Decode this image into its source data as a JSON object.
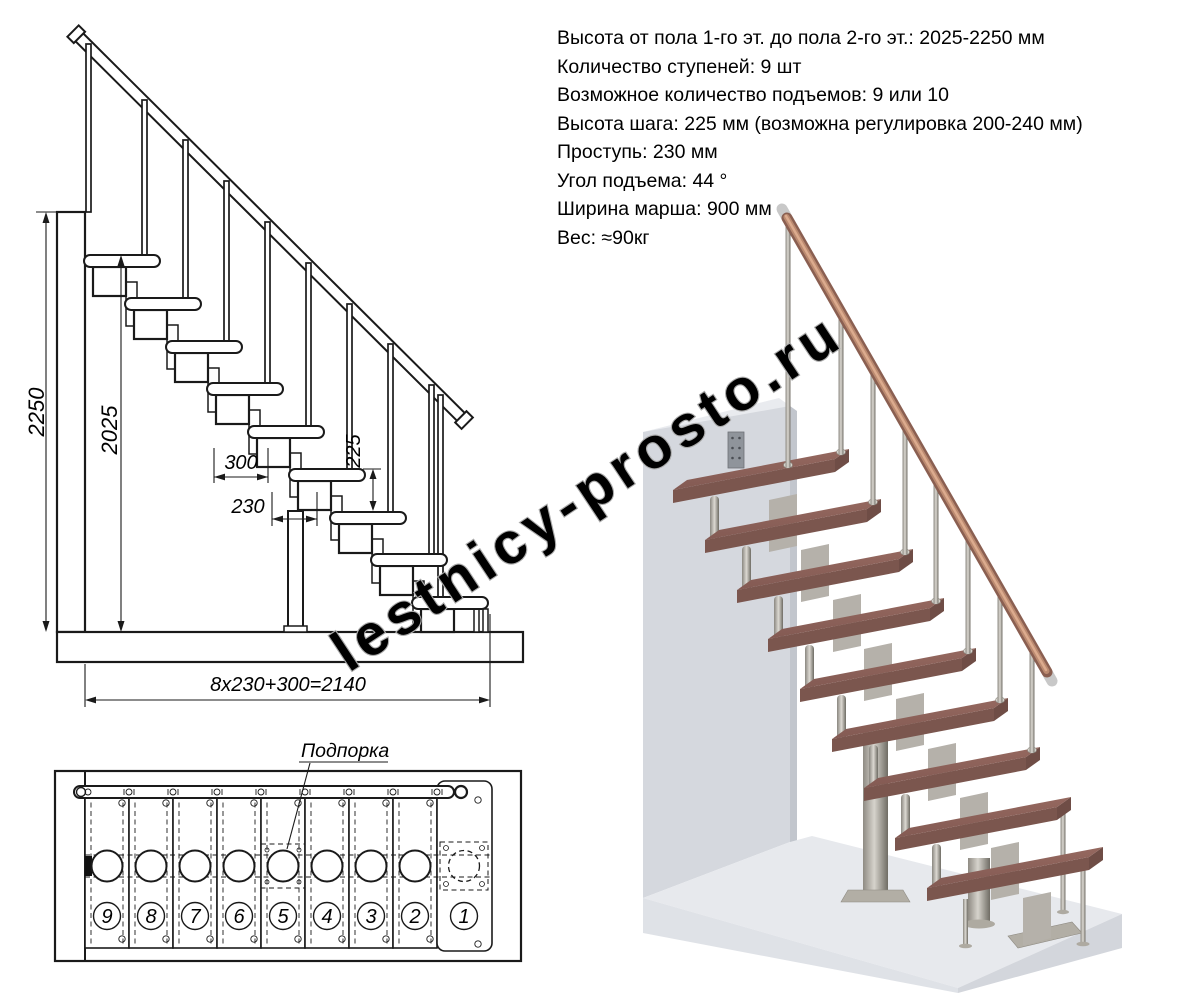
{
  "specs": {
    "lines": [
      "Высота от пола 1-го эт. до пола 2-го эт.: 2025-2250 мм",
      "Количество ступеней: 9 шт",
      "Возможное количество подъемов: 9 или 10",
      "Высота шага: 225 мм (возможна регулировка 200-240 мм)",
      "Проступь: 230 мм",
      "Угол подъема: 44 °",
      "Ширина марша: 900 мм",
      "Вес: ≈90кг"
    ]
  },
  "side_view": {
    "dims": {
      "total_height": "2250",
      "height_to_top_step": "2025",
      "top_step_depth": "300",
      "tread_depth": "230",
      "step_height": "225",
      "total_run": "8x230+300=2140"
    }
  },
  "plan_view": {
    "support_label": "Подпорка",
    "step_numbers": [
      "9",
      "8",
      "7",
      "6",
      "5",
      "4",
      "3",
      "2",
      "1"
    ]
  },
  "watermark": {
    "text": "lestnicy-prosto.ru"
  },
  "colors": {
    "line": "#1a1a1a",
    "tread_top": "#8c615a",
    "tread_front": "#7b564e",
    "tread_side": "#6f4d46",
    "rail_dark": "#8a5f51",
    "rail_mid": "#bb8a70",
    "rail_light": "#dcab8e",
    "metal_plate": "#b2aea5",
    "wall_front": "#d5d8de",
    "wall_top": "#e9ebef",
    "wall_side": "#c2c6cd",
    "floor_top": "#e7e9ed",
    "floor_front": "#dfe2e7",
    "floor_side": "#d3d6dc",
    "watermark": "#ababab"
  }
}
